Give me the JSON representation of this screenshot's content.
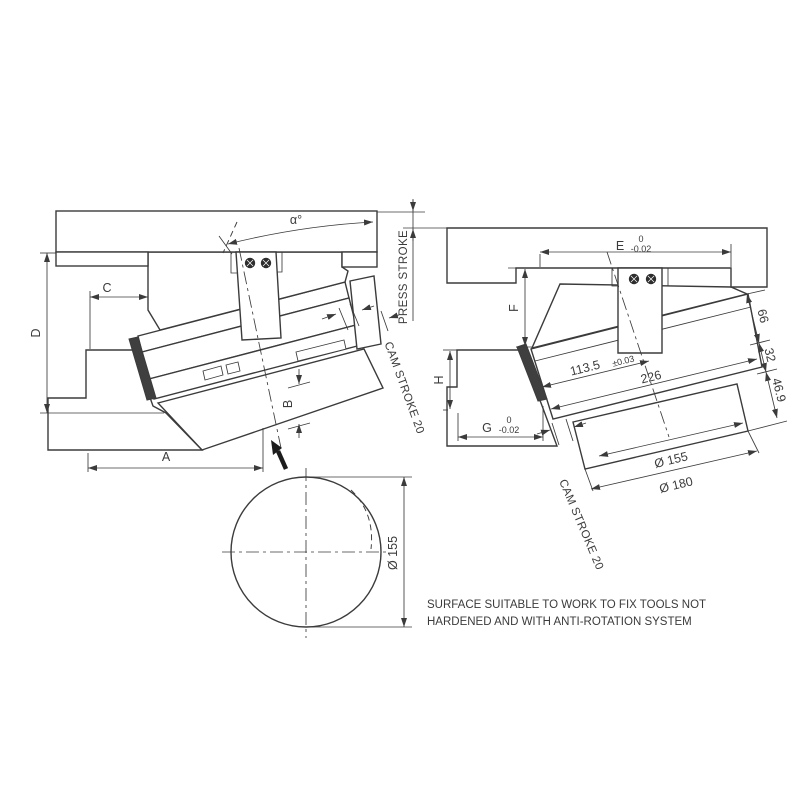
{
  "left_view": {
    "alpha": "α°",
    "press_stroke": "PRESS STROKE",
    "cam_stroke": "CAM STROKE 20",
    "dim_a": "A",
    "dim_b": "B",
    "dim_c": "C",
    "dim_d": "D",
    "circle_diameter": "Ø 155"
  },
  "right_view": {
    "cam_stroke": "CAM STROKE 20",
    "dim_e": "E",
    "dim_e_tol_upper": "0",
    "dim_e_tol_lower": "-0.02",
    "dim_f": "F",
    "dim_g": "G",
    "dim_g_tol_upper": "0",
    "dim_g_tol_lower": "-0.02",
    "dim_h": "H",
    "dim_113_5": "113.5",
    "dim_113_5_tol": "±0.03",
    "dim_226": "226",
    "dim_66": "66",
    "dim_32": "32",
    "dim_46_9": "46.9",
    "dia_155": "Ø 155",
    "dia_180": "Ø 180"
  },
  "note": {
    "line1": "SURFACE SUITABLE TO WORK TO FIX TOOLS NOT",
    "line2": "HARDENED AND WITH ANTI-ROTATION SYSTEM"
  },
  "colors": {
    "line": "#3b3b3b",
    "background": "#ffffff"
  }
}
